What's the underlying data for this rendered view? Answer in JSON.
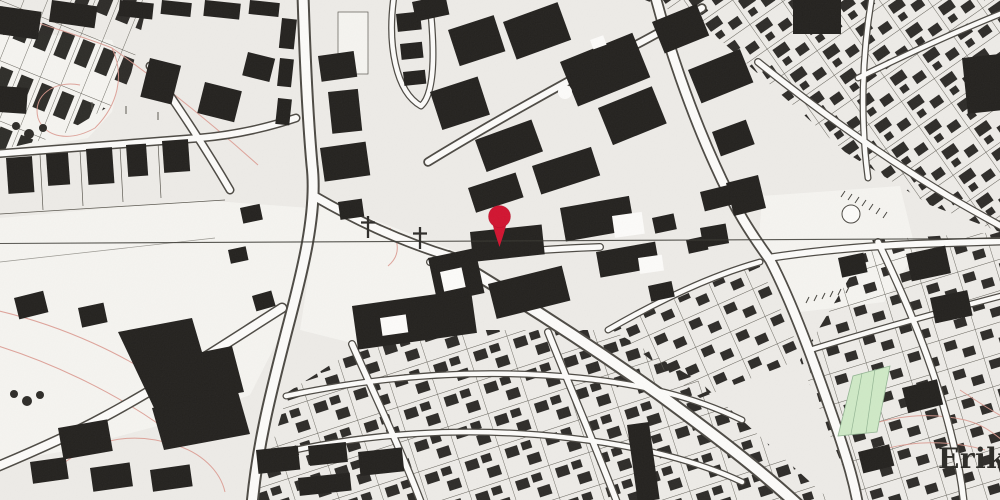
{
  "meta": {
    "type": "map-screenshot",
    "description": "Monochrome cadastral/topographic city map with red location marker"
  },
  "map": {
    "place_label": {
      "text": "Erik",
      "x": "938",
      "y": "468"
    },
    "marker": {
      "transform": "translate(499.5,216.5)",
      "color": "#d11430"
    },
    "grid_line": {
      "path": "M-2,243.5 L1002,238.5"
    },
    "crosses": [
      {
        "transform": "translate(368,227)"
      },
      {
        "transform": "translate(420,238)"
      }
    ],
    "features": {
      "green_area": "park parcel south-east",
      "pond": "round pond in open square",
      "church_crosses": 2,
      "contour_lines": "faint red elevation lines"
    },
    "colors": {
      "background": "#edebe7",
      "field": "#f5f4f0",
      "street_fill": "#fcfbf9",
      "street_casing": "#4d4a44",
      "building": "#24221f",
      "parcel_line": "#5b5850",
      "contour": "#dc9b91",
      "green_area": "#cfe9c6",
      "green_line": "#93b493",
      "label": "#2c2b27",
      "grid_line": "#3a3833",
      "cross_color": "#2e2c29",
      "hatch": "#47453f",
      "pin": "#d11430"
    }
  }
}
